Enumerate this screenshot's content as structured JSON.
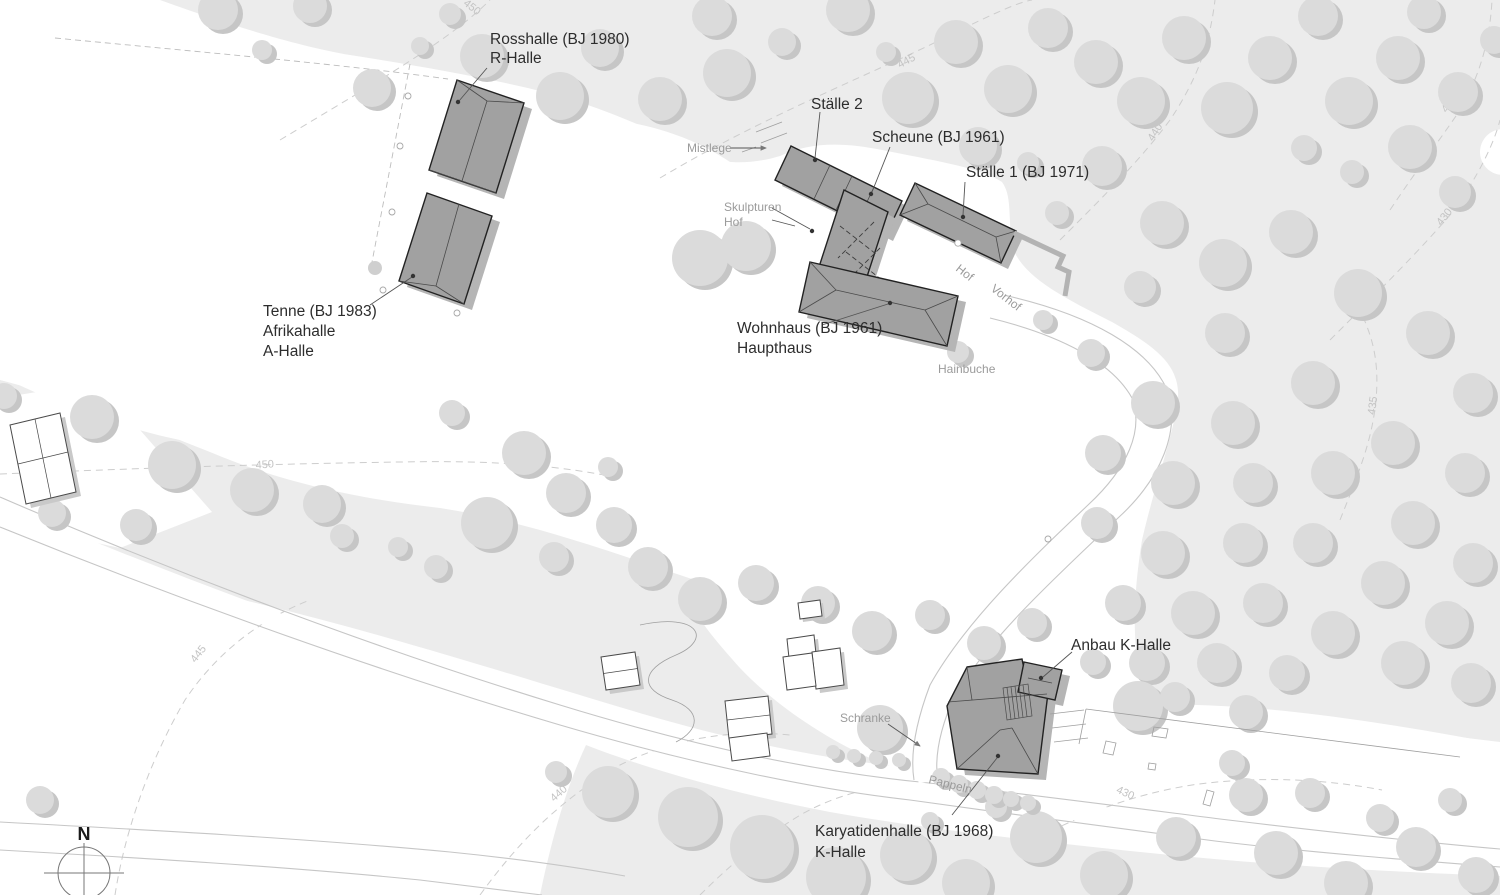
{
  "building_labels": {
    "rosshalle_1": "Rosshalle (BJ 1980)",
    "rosshalle_2": "R-Halle",
    "staelle2": "Ställe 2",
    "scheune": "Scheune (BJ 1961)",
    "staelle1": "Ställe 1 (BJ 1971)",
    "tenne_1": "Tenne (BJ 1983)",
    "tenne_2": "Afrikahalle",
    "tenne_3": "A-Halle",
    "wohnhaus_1": "Wohnhaus (BJ 1961)",
    "wohnhaus_2": "Haupthaus",
    "anbau": "Anbau K-Halle",
    "karyatiden_1": "Karyatidenhalle (BJ 1968)",
    "karyatiden_2": "K-Halle"
  },
  "site_labels": {
    "mistlege": "Mistlege",
    "skulpturen_1": "Skulpturen",
    "skulpturen_2": "Hof",
    "hof": "Hof",
    "vorhof": "Vorhof",
    "hainbuche": "Hainbuche",
    "schranke": "Schranke",
    "pappeln": "Pappeln"
  },
  "contour_labels": {
    "c450_top": "450",
    "c445_top": "445",
    "c440_top": "440",
    "c425_right": "425",
    "c430_right": "430",
    "c435_right": "435",
    "c450_left": "450",
    "c445_left": "445",
    "c440_bottom": "440",
    "c435_bottom": "435",
    "c430_bottom": "430"
  },
  "compass": {
    "north": "N"
  },
  "colors": {
    "forest": "#ececec",
    "cleared": "#ffffff",
    "tree": "#dbdbdb",
    "tree_shadow": "#c6c6c6",
    "building": "#a1a1a1",
    "building_outline": "#222222",
    "building_shadow": "#b5b5b5",
    "label_text": "#2d2d2d",
    "minor_label_text": "#9b9b9b",
    "contour": "#cdcdcd"
  }
}
